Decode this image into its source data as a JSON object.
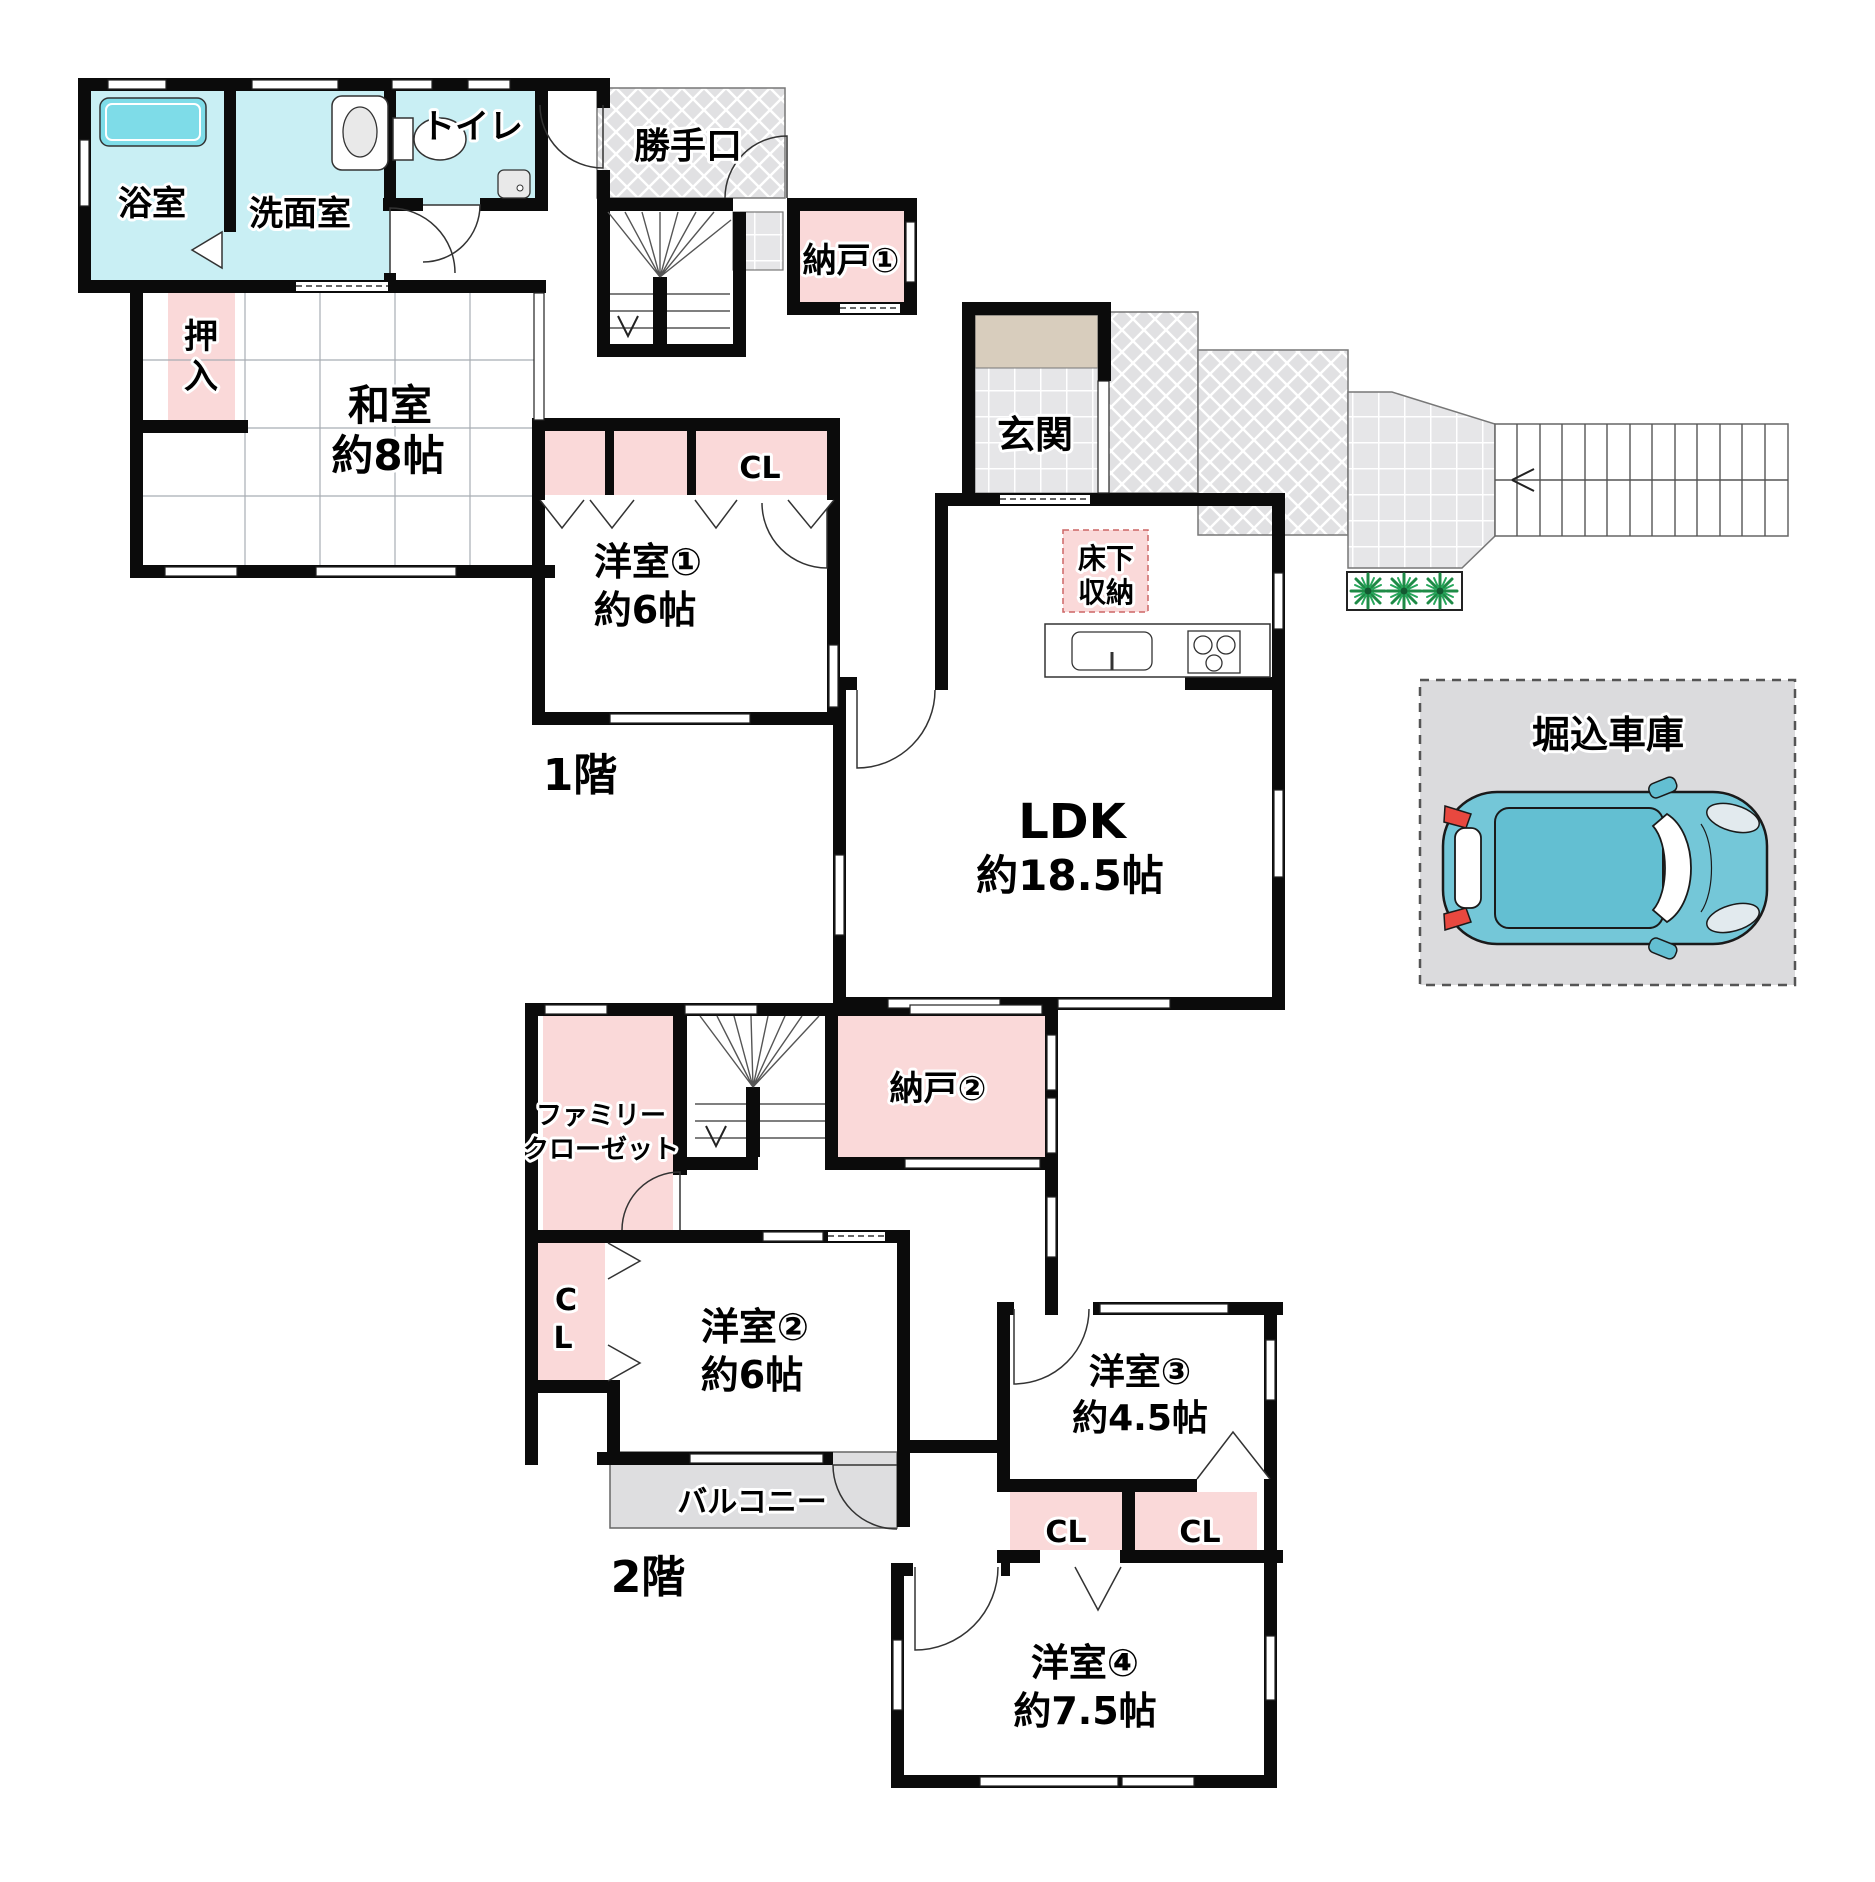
{
  "floor1": {
    "label": "1階",
    "bath": "浴室",
    "washroom": "洗面室",
    "toilet": "トイレ",
    "oshiire_1": "押",
    "oshiire_2": "入",
    "washitsu": "和室",
    "washitsu_size": "約8帖",
    "katteguchi": "勝手口",
    "nando1": "納戸①",
    "genkan": "玄関",
    "closet": "CL",
    "yukashita_1": "床下",
    "yukashita_2": "収納",
    "yoshitsu1": "洋室①",
    "yoshitsu1_size": "約6帖",
    "ldk": "LDK",
    "ldk_size": "約18.5帖"
  },
  "floor2": {
    "label": "2階",
    "family_closet_1": "ファミリー",
    "family_closet_2": "クローゼット",
    "nando2": "納戸②",
    "closet_c": "C",
    "closet_l": "L",
    "yoshitsu2": "洋室②",
    "yoshitsu2_size": "約6帖",
    "balcony": "バルコニー",
    "closet_left": "CL",
    "closet_right": "CL",
    "yoshitsu3": "洋室③",
    "yoshitsu3_size": "約4.5帖",
    "yoshitsu4": "洋室④",
    "yoshitsu4_size": "約7.5帖"
  },
  "garage": {
    "label": "堀込車庫"
  },
  "colors": {
    "wall": "#0b0b0b",
    "pink": "#FAD9D9",
    "cyan": "#C9EFF4",
    "tub": "#7EDCE8",
    "beige": "#D8CDBD",
    "balcony_gray": "#DEDEE0",
    "garage_gray": "#DBDBDD",
    "car_teal": "#74C7D8",
    "car_teal_dark": "#63BFD2",
    "plant_green": "#1E8A46"
  }
}
